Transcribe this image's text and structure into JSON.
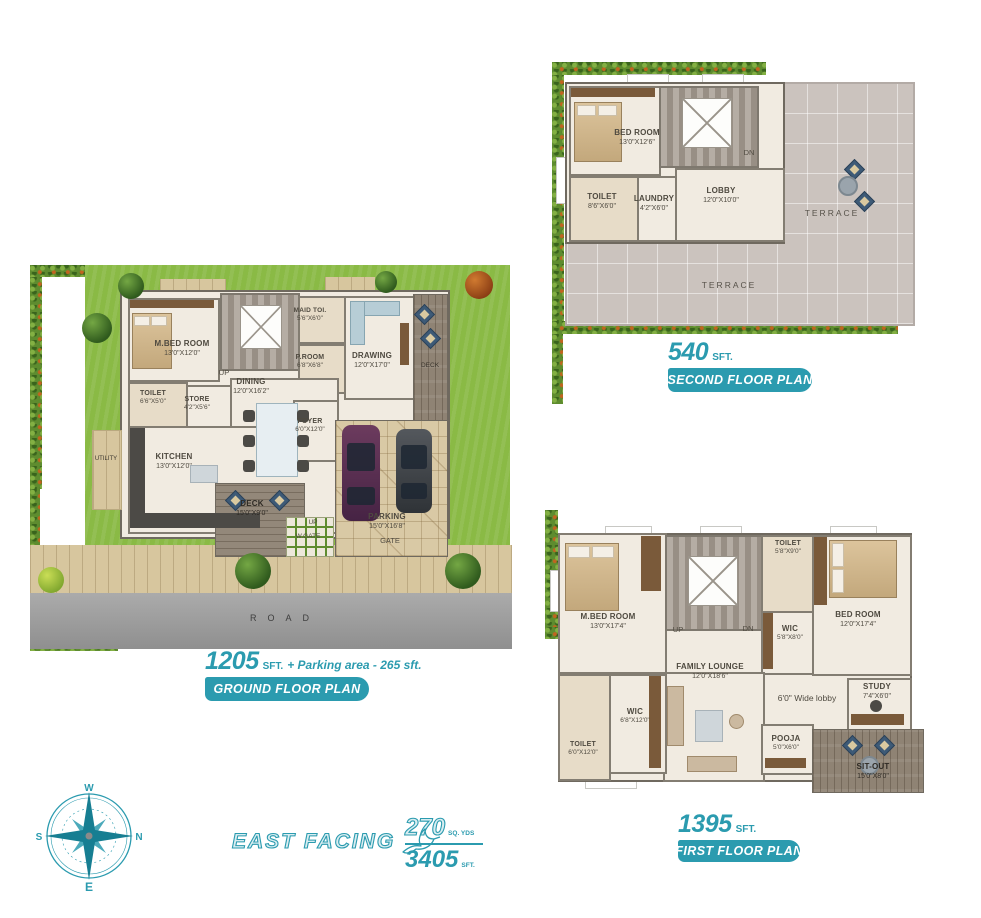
{
  "accent_color": "#2B9BAF",
  "compass": {
    "top": "W",
    "right": "N",
    "left": "S",
    "bottom": "E"
  },
  "facing_label": "EAST FACING",
  "area_summary": {
    "yds": "270",
    "yds_unit": "SQ. YDS",
    "sft": "3405",
    "sft_unit": "SFT."
  },
  "second_floor": {
    "area": "540",
    "area_unit": "SFT.",
    "badge": "SECOND FLOOR PLAN",
    "rooms": {
      "bedroom": {
        "name": "BED ROOM",
        "dim": "13'0\"X12'6\""
      },
      "toilet": {
        "name": "TOILET",
        "dim": "8'6\"X6'0\""
      },
      "laundry": {
        "name": "LAUNDRY",
        "dim": "4'2\"X6'0\""
      },
      "lobby": {
        "name": "LOBBY",
        "dim": "12'0\"X10'0\""
      },
      "terrace_right": {
        "name": "TERRACE"
      },
      "terrace_bottom": {
        "name": "TERRACE"
      },
      "dn": "DN"
    }
  },
  "ground_floor": {
    "area": "1205",
    "area_unit": "SFT.",
    "area_extra": "+ Parking area - 265 sft.",
    "badge": "GROUND FLOOR PLAN",
    "rooms": {
      "mbed": {
        "name": "M.BED ROOM",
        "dim": "13'0\"X12'0\""
      },
      "maid_toi": {
        "name": "MAID TOI.",
        "dim": "5'6\"X6'0\""
      },
      "proom": {
        "name": "P.ROOM",
        "dim": "6'8\"X6'8\""
      },
      "drawing": {
        "name": "DRAWING",
        "dim": "12'0\"X17'0\""
      },
      "deck_side": {
        "name": "DECK"
      },
      "toilet": {
        "name": "TOILET",
        "dim": "6'6\"X5'0\""
      },
      "store": {
        "name": "STORE",
        "dim": "4'2\"X5'6\""
      },
      "dining": {
        "name": "DINING",
        "dim": "12'0\"X16'2\""
      },
      "foyer": {
        "name": "FOYER",
        "dim": "6'0\"X12'0\""
      },
      "kitchen": {
        "name": "KITCHEN",
        "dim": "13'0\"X12'0\""
      },
      "utility": {
        "name": "UTILITY"
      },
      "deck": {
        "name": "DECK",
        "dim": "15'0\"X9'0\""
      },
      "parking": {
        "name": "PARKING",
        "dim": "15'0\"X16'8\""
      },
      "gate": "GATE",
      "wgate": "W.GATE",
      "up_stairs": "UP",
      "up_gate": "UP",
      "road": "ROAD"
    }
  },
  "first_floor": {
    "area": "1395",
    "area_unit": "SFT.",
    "badge": "FIRST FLOOR PLAN",
    "rooms": {
      "mbed": {
        "name": "M.BED ROOM",
        "dim": "13'0\"X17'4\""
      },
      "toilet_top": {
        "name": "TOILET",
        "dim": "5'8\"X9'0\""
      },
      "bedroom": {
        "name": "BED ROOM",
        "dim": "12'0\"X17'4\""
      },
      "wic_top": {
        "name": "WIC",
        "dim": "5'8\"X8'0\""
      },
      "family": {
        "name": "FAMILY LOUNGE",
        "dim": "12'0\"X18'6\""
      },
      "wic_left": {
        "name": "WIC",
        "dim": "6'8\"X12'0\""
      },
      "toilet_left": {
        "name": "TOILET",
        "dim": "6'0\"X12'0\""
      },
      "lobby_note": "6'0\" Wide lobby",
      "study": {
        "name": "STUDY",
        "dim": "7'4\"X6'0\""
      },
      "pooja": {
        "name": "POOJA",
        "dim": "5'0\"X6'0\""
      },
      "sitout": {
        "name": "SIT-OUT",
        "dim": "15'0\"X8'0\""
      },
      "up": "UP",
      "dn": "DN"
    }
  }
}
